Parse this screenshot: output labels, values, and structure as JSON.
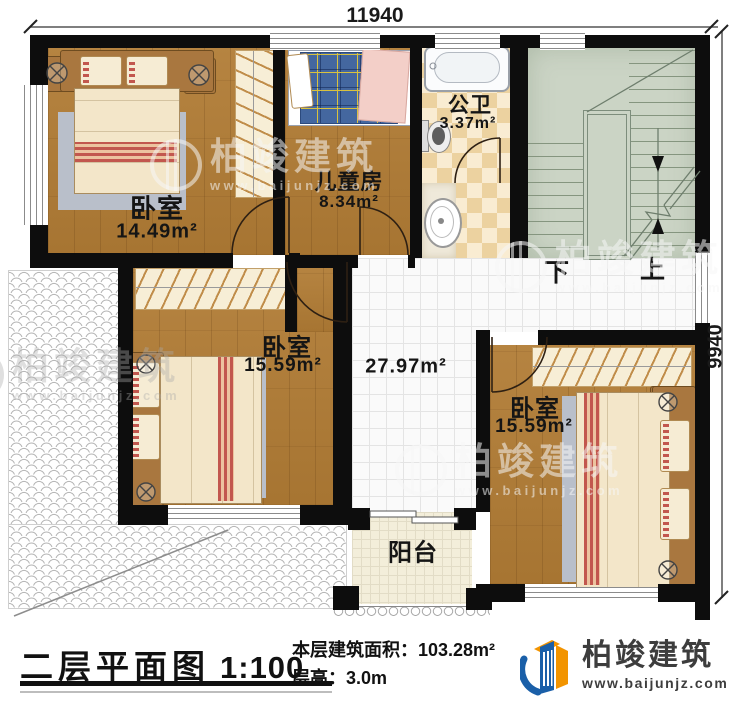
{
  "plan": {
    "dim_top": "11940",
    "dim_right": "9940",
    "rooms": {
      "bedroom1": {
        "label": "卧室",
        "area": "14.49m²"
      },
      "kids": {
        "label": "儿童房",
        "area": "8.34m²"
      },
      "bath": {
        "label": "公卫",
        "area": "3.37m²"
      },
      "bedroom2": {
        "label": "卧室",
        "area": "15.59m²"
      },
      "hall": {
        "area": "27.97m²"
      },
      "bedroom3": {
        "label": "卧室",
        "area": "15.59m²"
      },
      "balcony": {
        "label": "阳台"
      }
    },
    "stairs": {
      "down": "下",
      "up": "上"
    }
  },
  "footer": {
    "title": "二层平面图",
    "scale": "1:100",
    "area_line": "本层建筑面积：103.28m²",
    "height_line": "层高：3.0m"
  },
  "brand": {
    "name": "柏竣建筑",
    "site": "www.baijunjz.com"
  },
  "watermark": {
    "name": "柏竣建筑",
    "site": "www.baijunjz.com"
  },
  "colors": {
    "wood": "#b17c35",
    "stair": "#cbd4c5",
    "logo_blue": "#1a5fa8",
    "logo_orange": "#f29400"
  }
}
